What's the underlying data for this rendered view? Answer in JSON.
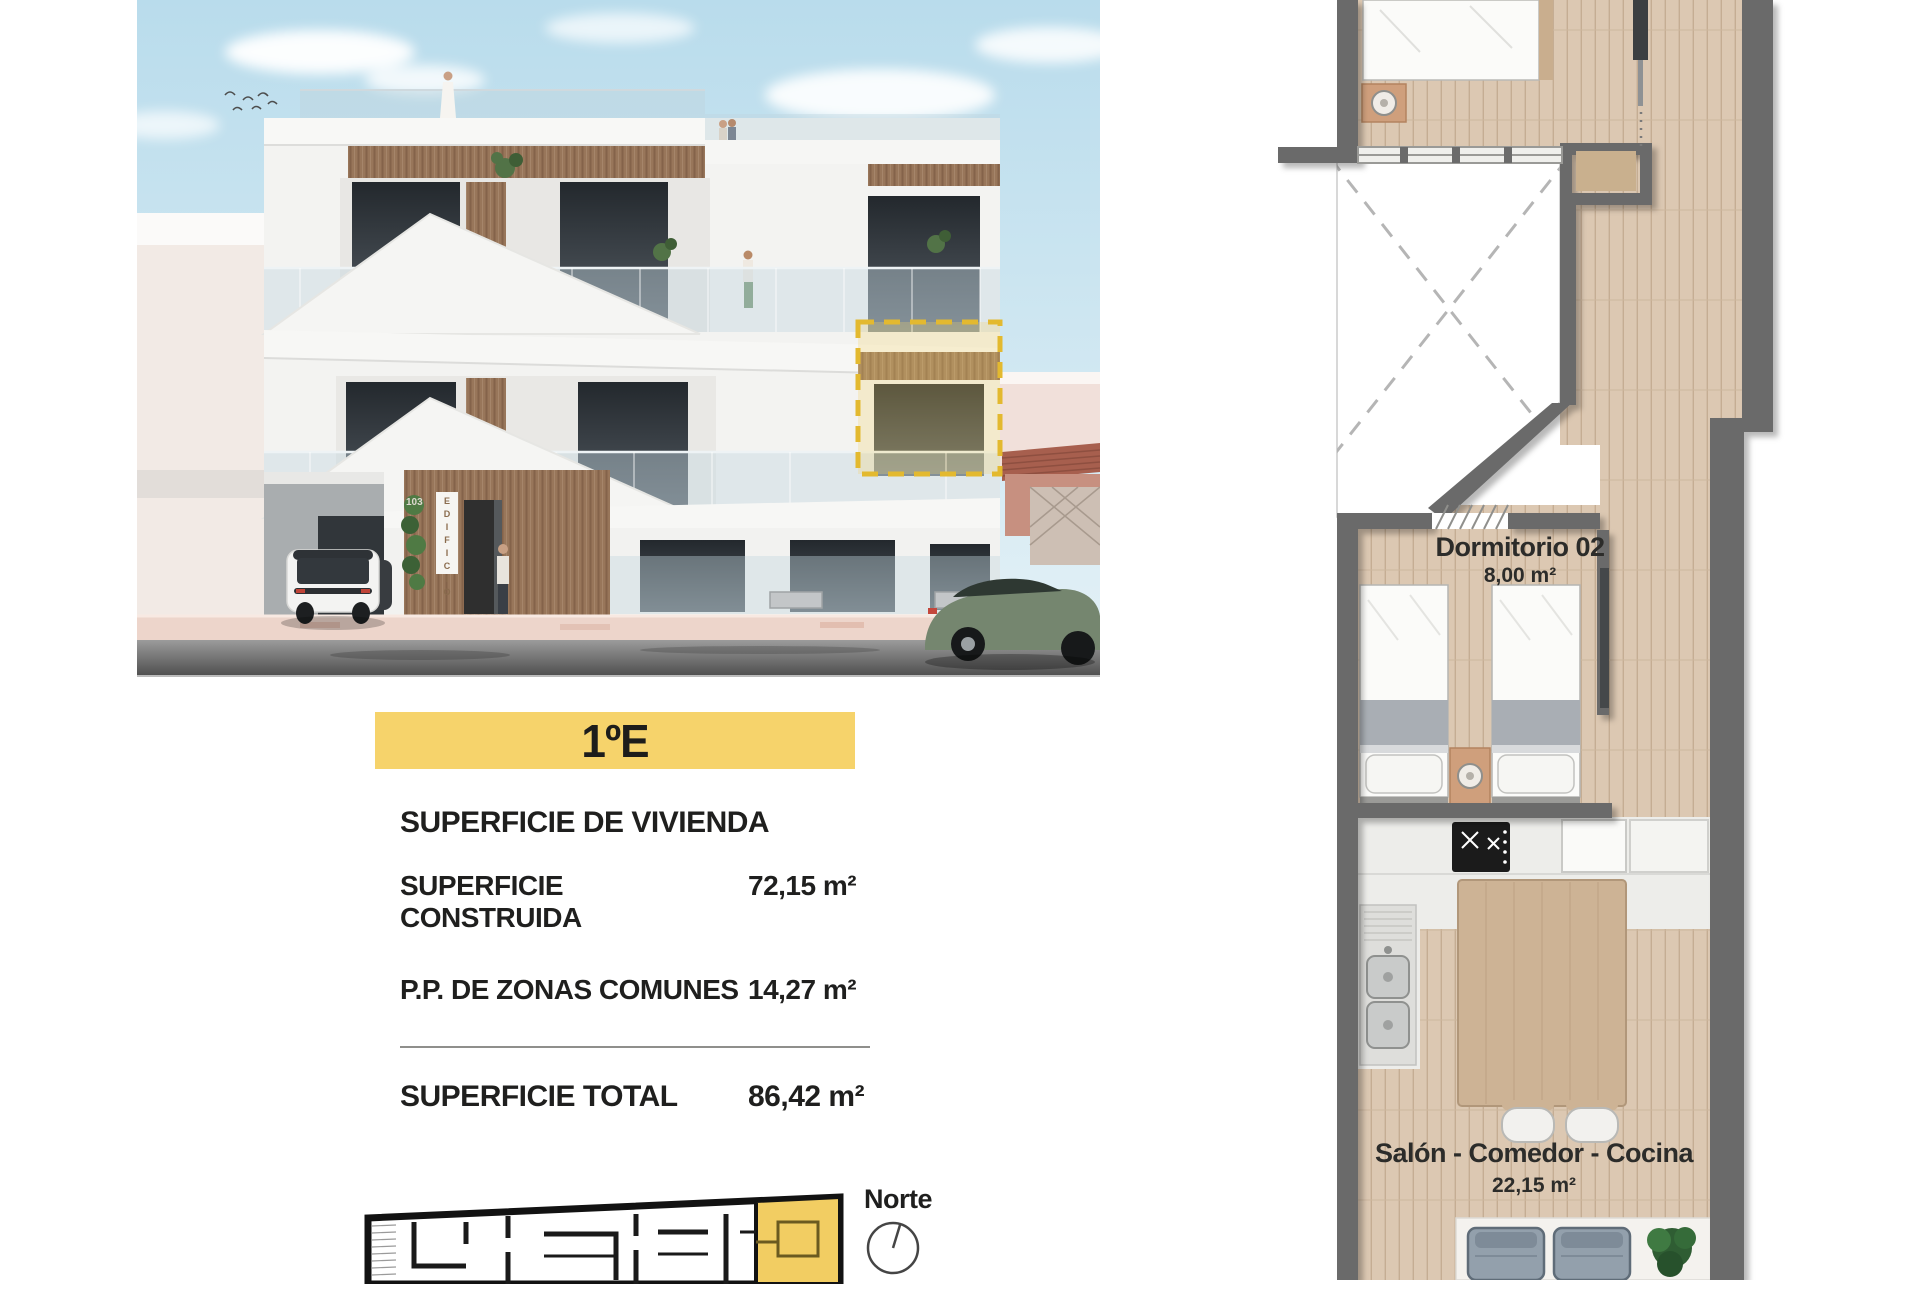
{
  "unit": {
    "label": "1ºE"
  },
  "surface_panel": {
    "title": "SUPERFICIE DE VIVIENDA",
    "rows": [
      {
        "label": "SUPERFICIE CONSTRUIDA",
        "value": "72,15 m²"
      },
      {
        "label": "P.P. DE ZONAS COMUNES",
        "value": "14,27 m²"
      }
    ],
    "total": {
      "label": "SUPERFICIE TOTAL",
      "value": "86,42 m²"
    }
  },
  "locator": {
    "north_label": "Norte"
  },
  "building_render": {
    "entrance_sign": "EDIFICIO",
    "street_number": "103"
  },
  "floorplan": {
    "rooms": [
      {
        "name": "Dormitorio 02",
        "area": "8,00 m²"
      },
      {
        "name": "Salón - Comedor - Cocina",
        "area": "22,15 m²"
      }
    ]
  },
  "colors": {
    "accent_yellow": "#f6d36b",
    "highlight_dashed": "#e3b92f",
    "plan_wall_gray": "#6b6b6b",
    "wood_floor": "#dcc8b2",
    "text_dark": "#1f1f1e",
    "sky_blue": "#bfe0ee"
  }
}
